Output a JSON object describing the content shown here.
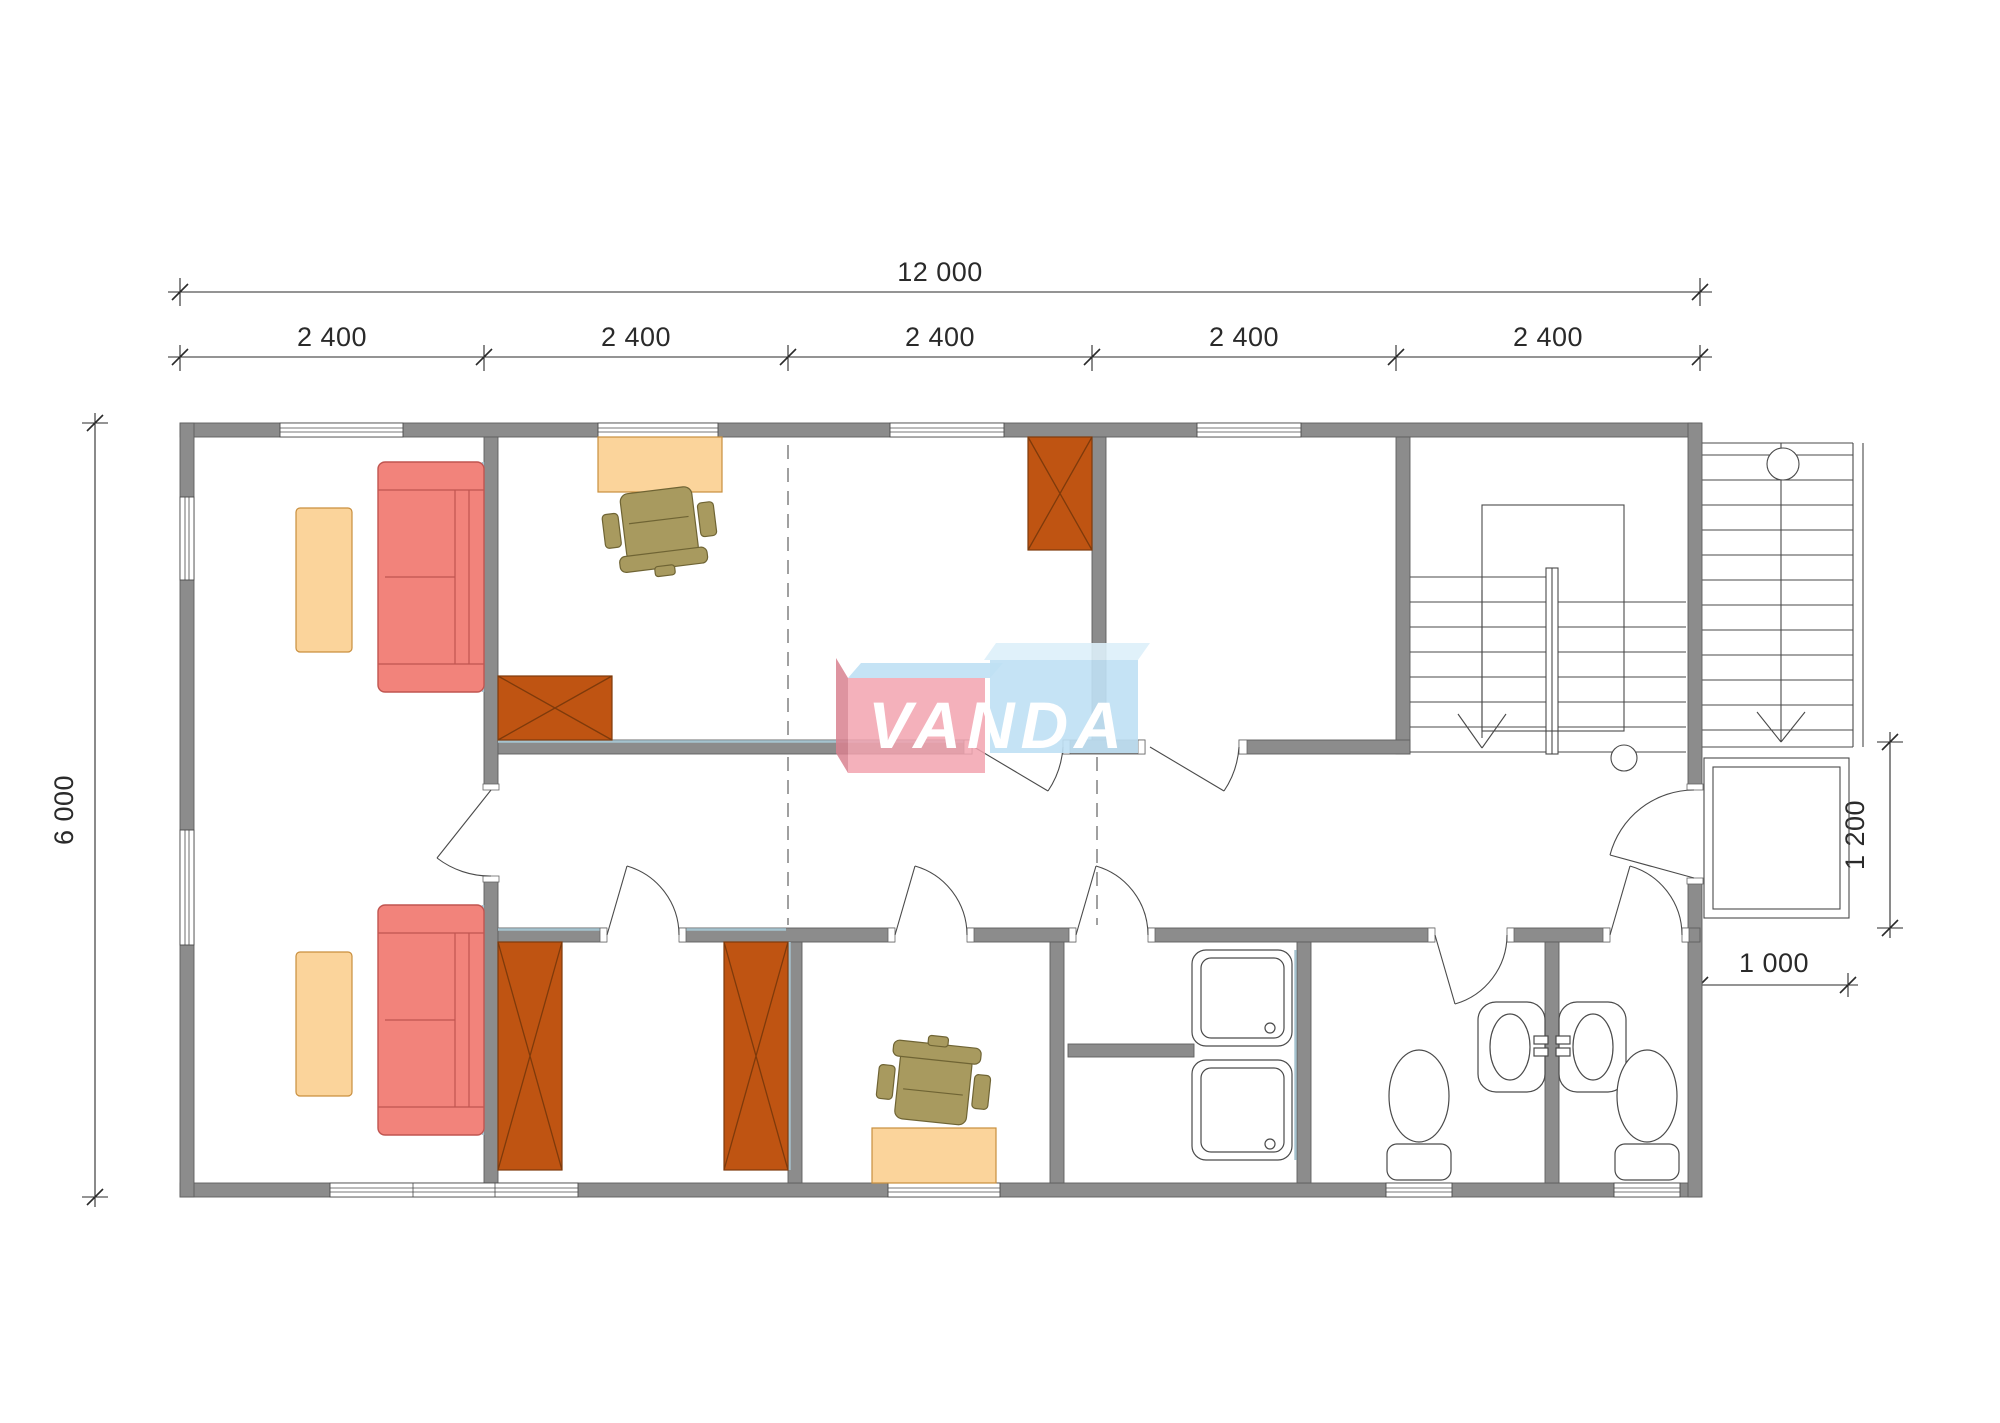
{
  "drawing": {
    "type": "floor-plan",
    "watermark": {
      "text": "VANDA"
    },
    "dimensions": {
      "total_width": {
        "label": "12 000"
      },
      "modules": [
        {
          "label": "2 400"
        },
        {
          "label": "2 400"
        },
        {
          "label": "2 400"
        },
        {
          "label": "2 400"
        },
        {
          "label": "2 400"
        }
      ],
      "height": {
        "label": "6 000"
      },
      "porch_depth": {
        "label": "1 200"
      },
      "porch_width": {
        "label": "1 000"
      }
    },
    "colors": {
      "wall": "#8C8C8C",
      "wall_outline": "#5E5E5E",
      "dimension": "#2A2A2A",
      "stair_line": "#4A4A4A",
      "door_arc": "#4A4A4A",
      "dashed_line": "#777777",
      "fixture_outline": "#4A4A4A",
      "sofa": "#F2837B",
      "sofa_outline": "#C05550",
      "table": "#FBD49B",
      "table_outline": "#C98F3E",
      "chair": "#A89A5F",
      "chair_outline": "#6F6434",
      "wardrobe": "#BF5412",
      "wardrobe_outline": "#7E3A0B",
      "accent_blue": "#A5C3CF",
      "logo_pink": "#F2A3AF",
      "logo_blue": "#BFE0F4",
      "logo_blue_light": "#DDEFFA",
      "logo_dark_pink": "#D8818F"
    }
  }
}
